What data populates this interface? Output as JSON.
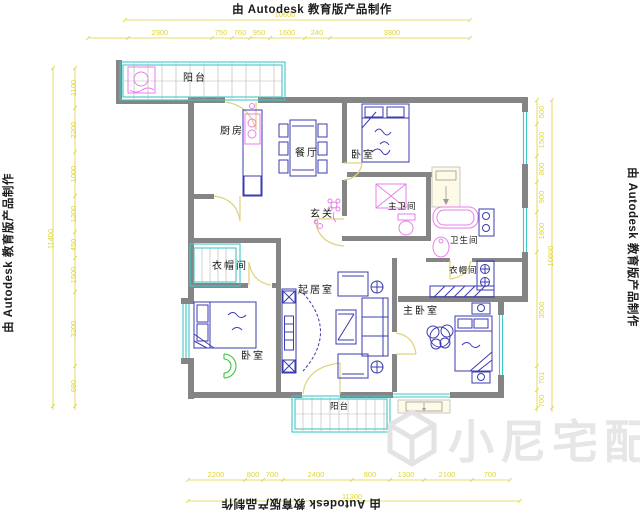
{
  "watermarks": {
    "autodesk_top": "由 Autodesk 教育版产品制作",
    "autodesk_bottom": "由 Autodesk 教育版产品制作",
    "autodesk_left": "由 Autodesk 教育版产品制作",
    "autodesk_right": "由 Autodesk 教育版产品制作",
    "brand": "小尼宅配"
  },
  "rooms": {
    "balcony_top": "阳台",
    "kitchen": "厨房",
    "dining": "餐厅",
    "bedroom_top": "卧室",
    "entry": "玄关",
    "master_bath": "主卫间",
    "bath": "卫生间",
    "closet_right": "衣帽间",
    "closet_left": "衣帽间",
    "living": "起居室",
    "master_bedroom": "主卧室",
    "bedroom_bottom": "卧室",
    "balcony_bottom": "阳台"
  },
  "dimensions": {
    "top": {
      "overall": "10600",
      "segments": [
        "2900",
        "750",
        "760",
        "950",
        "1600",
        "240",
        "3800"
      ]
    },
    "bottom": {
      "overall": "11300",
      "segments": [
        "2200",
        "800",
        "700",
        "2400",
        "800",
        "1300",
        "2100",
        "700"
      ]
    },
    "left": {
      "overall": "11400",
      "segments": [
        "1100",
        "2200",
        "1000",
        "1200",
        "450",
        "1500",
        "3200",
        "680"
      ]
    },
    "right": {
      "overall": "10600",
      "segments": [
        "500",
        "1500",
        "800",
        "900",
        "1800",
        "3500",
        "701",
        "700"
      ]
    }
  },
  "colors": {
    "wall": "#858585",
    "furniture": "#3b3bb2",
    "fixture": "#e87fe8",
    "window": "#3fc6c6",
    "door": "#ded37e",
    "dimension": "#e0d53a",
    "label": "#161616",
    "watermark": "#e6e6e6"
  }
}
